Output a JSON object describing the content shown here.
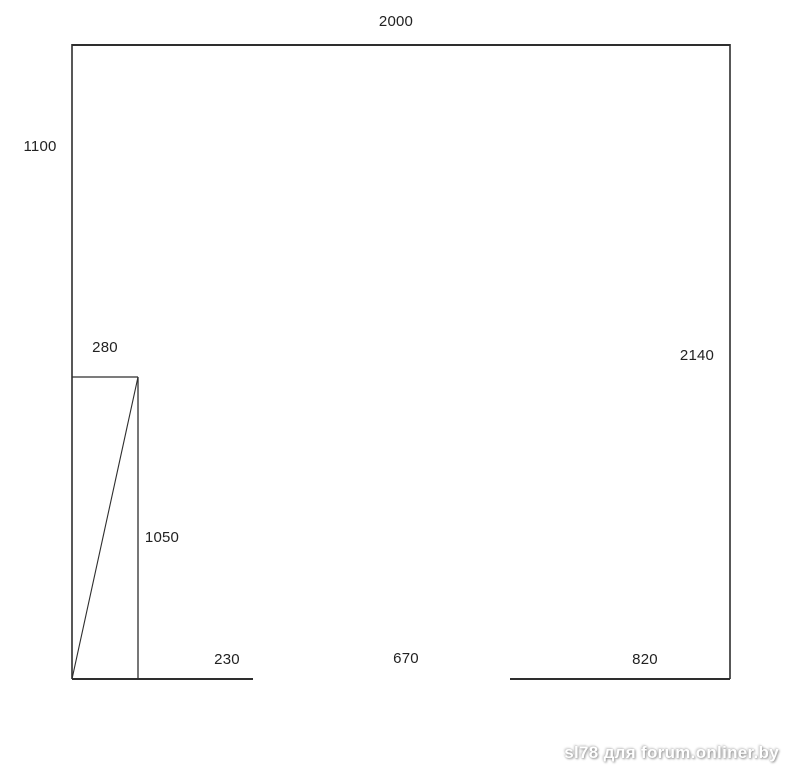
{
  "sketch": {
    "description": "wall-elevation-dimension-sketch",
    "line_color": "#2e2e2e",
    "dimension_labels": {
      "top_width": "2000",
      "left_upper_height": "1100",
      "door_width": "280",
      "right_height": "2140",
      "door_height": "1050",
      "bottom_left_segment": "230",
      "bottom_opening": "670",
      "bottom_right_segment": "820"
    }
  },
  "watermark": {
    "text": "sl78 для forum.onliner.by"
  }
}
